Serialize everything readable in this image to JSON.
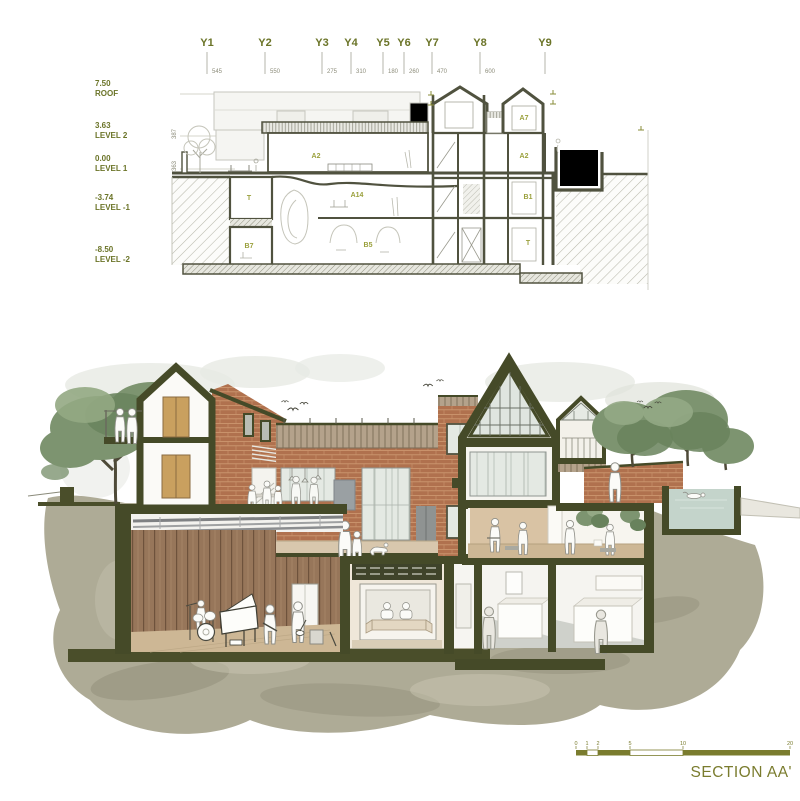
{
  "colors": {
    "accent": "#7a7c2e",
    "grid-green": "#6b7428",
    "room-green": "#9aa03c",
    "dim-gray": "#8d8d7b",
    "section-cut-dark": "#454a28",
    "brick": "#b0714e",
    "wood-wall": "#97765a",
    "floor-tan": "#cdb795",
    "glass": "#e4e9e3",
    "tree-green": "#7d9470",
    "wash-khaki": "#a7a48d"
  },
  "technical_drawing": {
    "grid_axes": [
      {
        "label": "Y1",
        "spacing": "545"
      },
      {
        "label": "Y2",
        "spacing": "550"
      },
      {
        "label": "Y3",
        "spacing": "275"
      },
      {
        "label": "Y4",
        "spacing": "310"
      },
      {
        "label": "Y5",
        "spacing": "180"
      },
      {
        "label": "Y6",
        "spacing": "260"
      },
      {
        "label": "Y7",
        "spacing": "470"
      },
      {
        "label": "Y8",
        "spacing": "600"
      },
      {
        "label": "Y9",
        "spacing": ""
      }
    ],
    "levels": [
      {
        "elevation": "7.50",
        "name": "ROOF",
        "height_dim": ""
      },
      {
        "elevation": "3.63",
        "name": "LEVEL 2",
        "height_dim": "387"
      },
      {
        "elevation": "0.00",
        "name": "LEVEL 1",
        "height_dim": "363"
      },
      {
        "elevation": "-3.74",
        "name": "LEVEL -1",
        "height_dim": "374"
      },
      {
        "elevation": "-8.50",
        "name": "LEVEL -2",
        "height_dim": "476"
      }
    ],
    "room_labels": {
      "a2_main": "A2",
      "a14": "A14",
      "b5": "B5",
      "t_left": "T",
      "b7": "B7",
      "a7": "A7",
      "a2_upper_right": "A2",
      "b1": "B1",
      "t_right": "T"
    }
  },
  "rendered_drawing": {
    "caption": "SECTION AA'",
    "scale_bar": {
      "tick_labels": [
        "0",
        "1",
        "2",
        "5",
        "10",
        "20"
      ]
    }
  }
}
